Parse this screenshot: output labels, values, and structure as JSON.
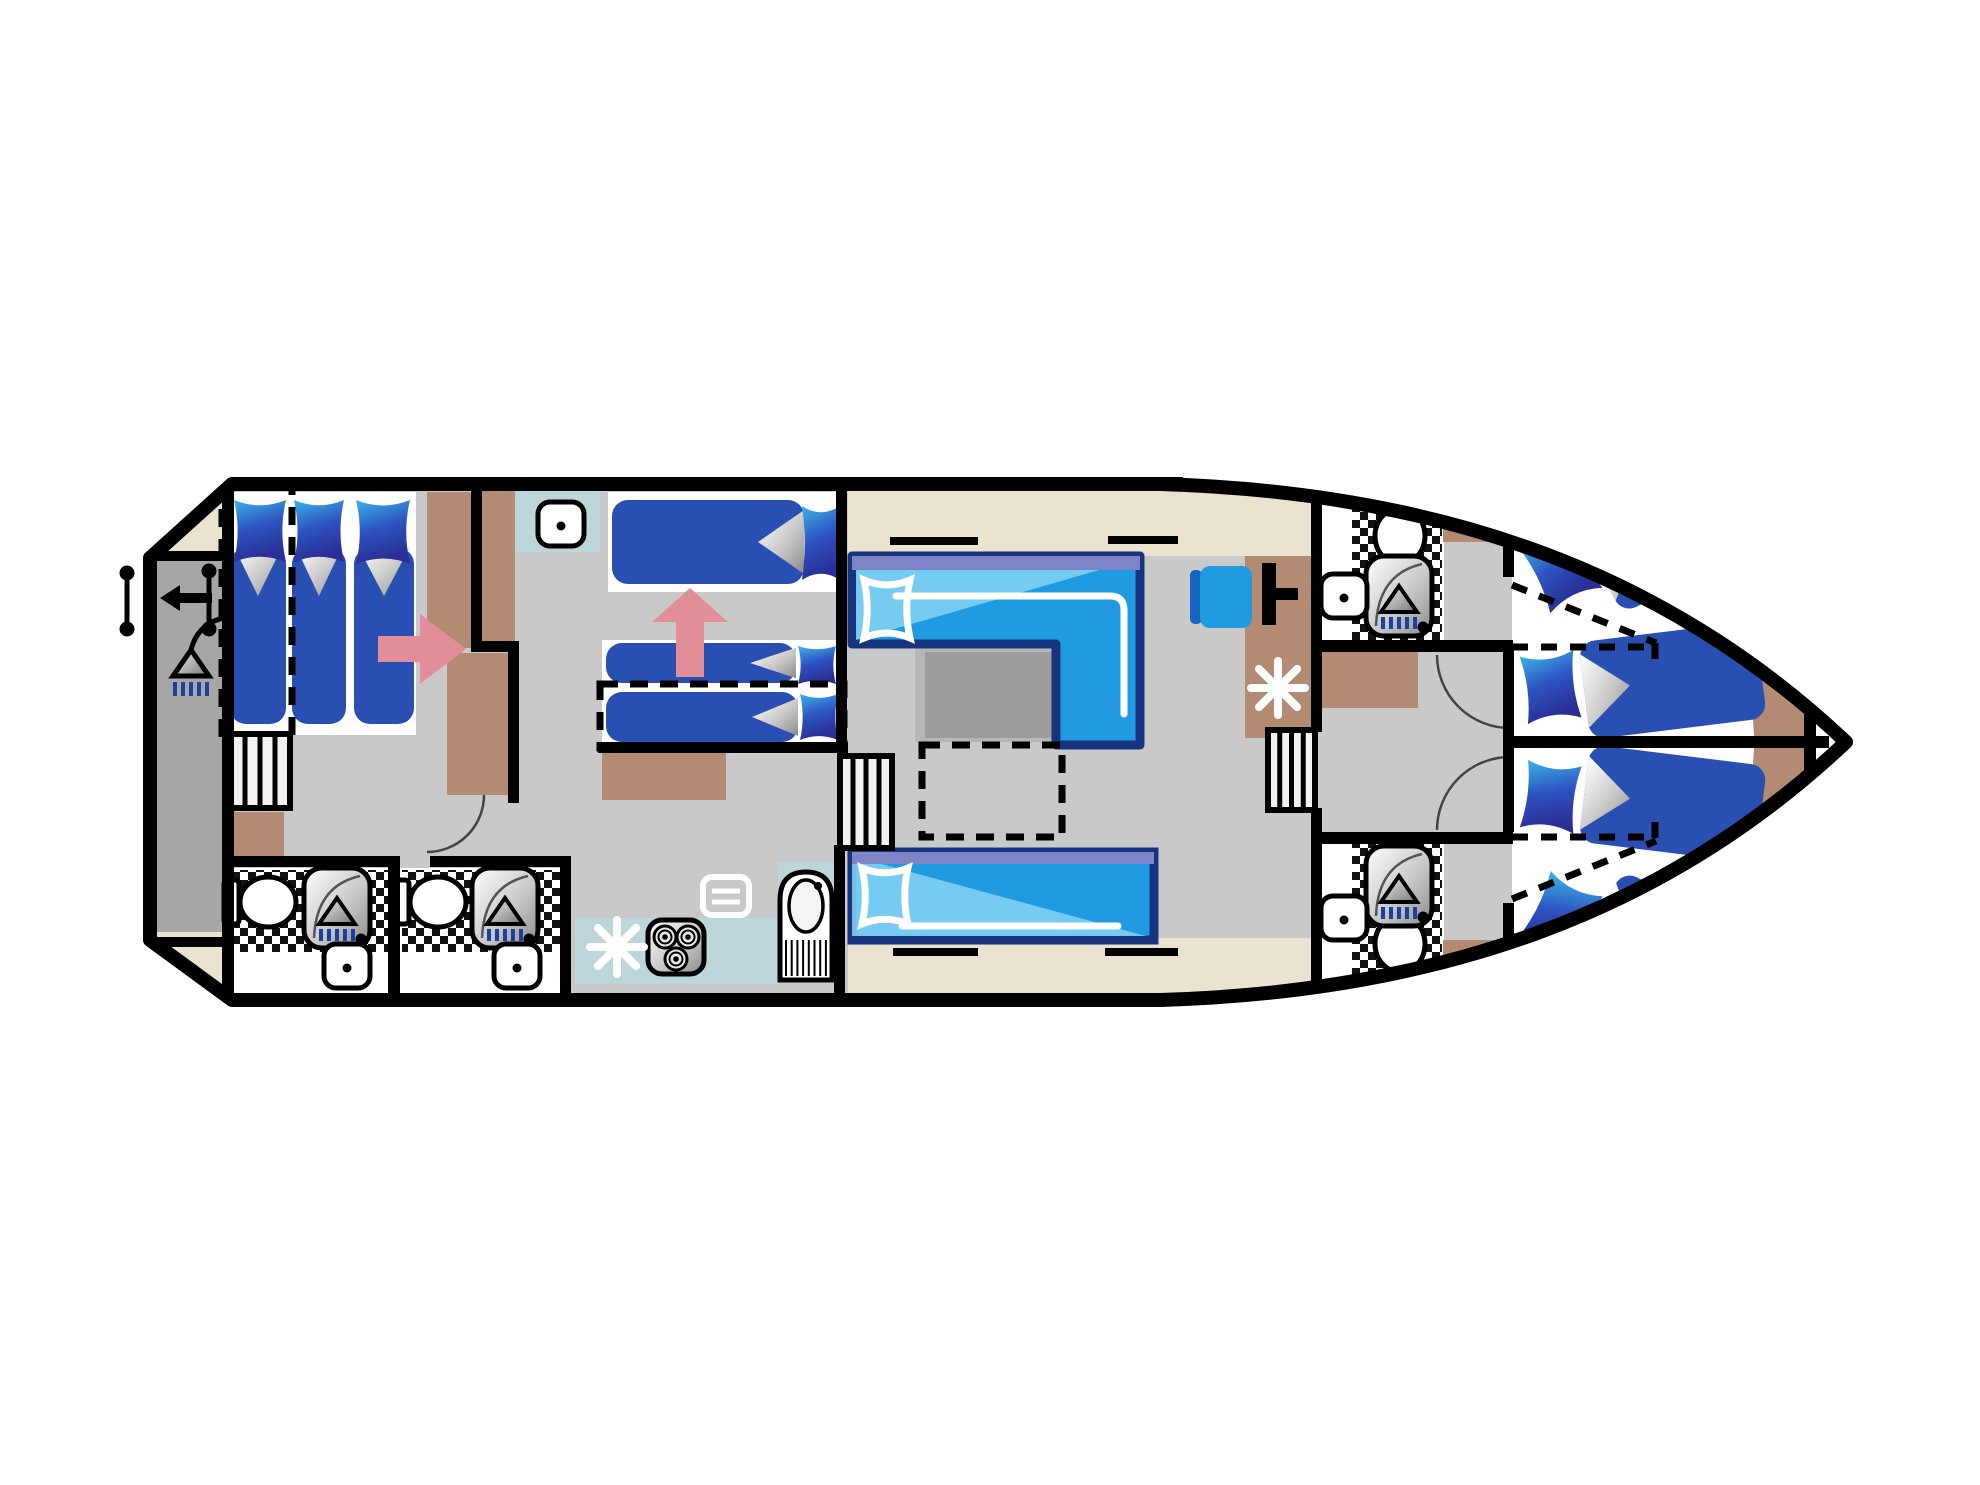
{
  "plan": {
    "meta": {
      "type": "boat-deck-floor-plan",
      "orientation": "bow-right-stern-left"
    },
    "palette": {
      "floor": "#c9c9c9",
      "platform": "#a6a6a6",
      "cream": "#e9e3d0",
      "brown": "#b28b72",
      "teal": "#bcd6d9",
      "duvet": "#2a4fb2",
      "pillowLight": "#3cb4e8",
      "pillowDark": "#2a2e96",
      "sofa": "#209be2",
      "sofaLight": "#7fd0f4",
      "sofaBorder": "#17357e",
      "sofaPurple": "#7d85c8",
      "tableLight": "#b6b6b6",
      "tableDark": "#9c9c9c",
      "pink": "#e28e98",
      "drip": "#1c3fa4",
      "wall": "#000000",
      "white": "#ffffff",
      "stairFill": "#f2f2f2"
    },
    "hull": {
      "path": "M 232,484 L 1160,484 C 1430,492 1660,566 1846,742 C 1660,918 1430,992 1160,1000 L 232,1000 L 150,940 L 150,558 Z",
      "strokeWidth": 14,
      "hatchBar": [
        1103,
        477,
        80,
        13
      ]
    },
    "floors": {
      "platform": [
        150,
        560,
        74,
        378
      ],
      "creams": [
        [
          150,
          487,
          82,
          68
        ],
        [
          150,
          932,
          82,
          66
        ],
        [
          848,
          488,
          467,
          68
        ],
        [
          848,
          938,
          467,
          62
        ]
      ],
      "creamTip": "M 1816,648 Q 1838,698 1843,742 Q 1838,786 1816,836 Z",
      "whiteRooms": [
        [
          232,
          868,
          160,
          130
        ],
        [
          400,
          868,
          162,
          130
        ],
        [
          1322,
          487,
          122,
          156
        ],
        [
          1322,
          842,
          122,
          156
        ],
        [
          1512,
          486,
          342,
          516
        ]
      ],
      "mattresses": [
        [
          226,
          492,
          126,
          243
        ],
        [
          348,
          492,
          68,
          243
        ],
        [
          608,
          492,
          236,
          100
        ],
        [
          602,
          640,
          242,
          106
        ]
      ],
      "teals": [
        [
          512,
          490,
          88,
          62
        ],
        [
          575,
          918,
          265,
          66
        ],
        [
          778,
          862,
          62,
          122
        ]
      ],
      "tiles": [
        [
          234,
          870,
          154,
          82
        ],
        [
          402,
          870,
          160,
          82
        ],
        [
          1352,
          492,
          90,
          150
        ],
        [
          1352,
          842,
          90,
          150
        ]
      ],
      "browns": [
        [
          427,
          492,
          46,
          156
        ],
        [
          477,
          490,
          38,
          158
        ],
        [
          447,
          653,
          62,
          142
        ],
        [
          228,
          812,
          56,
          48
        ],
        [
          602,
          750,
          124,
          50
        ],
        [
          1245,
          556,
          70,
          182
        ],
        [
          1320,
          652,
          98,
          56
        ],
        [
          1443,
          490,
          68,
          52
        ],
        [
          1443,
          940,
          68,
          53
        ]
      ],
      "brownPaths": [
        "M 1736,564 L 1776,594 L 1798,652 L 1806,736 L 1754,736 L 1748,640 Z",
        "M 1754,748 L 1806,748 L 1798,832 L 1776,890 L 1736,920 L 1748,844 Z"
      ]
    },
    "walls": [
      [
        222,
        484,
        12,
        518
      ],
      [
        150,
        551,
        82,
        10
      ],
      [
        150,
        937,
        82,
        10
      ],
      [
        471,
        487,
        11,
        160
      ],
      [
        471,
        641,
        48,
        11
      ],
      [
        508,
        648,
        11,
        155
      ],
      [
        232,
        856,
        158,
        11
      ],
      [
        430,
        856,
        140,
        11
      ],
      [
        388,
        856,
        12,
        144
      ],
      [
        560,
        856,
        11,
        144
      ],
      [
        836,
        487,
        11,
        260
      ],
      [
        598,
        742,
        250,
        11
      ],
      [
        834,
        845,
        11,
        155
      ],
      [
        1311,
        487,
        11,
        245
      ],
      [
        1311,
        808,
        11,
        192
      ],
      [
        1321,
        640,
        192,
        12
      ],
      [
        1321,
        832,
        192,
        12
      ],
      [
        1503,
        487,
        11,
        90
      ],
      [
        1503,
        648,
        11,
        184
      ],
      [
        1503,
        903,
        11,
        99
      ],
      [
        1513,
        736,
        316,
        12
      ],
      [
        1804,
        644,
        12,
        200
      ]
    ],
    "dashedRects": [
      {
        "name": "aft-convertible-bed-outline",
        "r": [
          222,
          487,
          70,
          250
        ]
      },
      {
        "name": "mid-pullout-bed-outline",
        "r": [
          600,
          684,
          244,
          64
        ]
      },
      {
        "name": "salon-table-extension",
        "r": [
          922,
          745,
          140,
          92
        ]
      }
    ],
    "dashedLines": [
      [
        1512,
        585,
        1656,
        643
      ],
      [
        1512,
        647,
        1652,
        647
      ],
      [
        1655,
        643,
        1655,
        662
      ],
      [
        1512,
        899,
        1656,
        841
      ],
      [
        1512,
        837,
        1652,
        837
      ],
      [
        1655,
        822,
        1655,
        841
      ]
    ],
    "beds": [
      {
        "name": "aft-cabin-bed-1",
        "pillow": [
          234,
          500,
          52,
          62
        ],
        "duvet": [
          230,
          548,
          56,
          176
        ],
        "fold": "top"
      },
      {
        "name": "aft-cabin-bed-2",
        "pillow": [
          294,
          500,
          50,
          62
        ],
        "duvet": [
          292,
          548,
          54,
          176
        ],
        "fold": "top"
      },
      {
        "name": "aft-cabin-bed-3",
        "pillow": [
          356,
          500,
          54,
          64
        ],
        "duvet": [
          354,
          548,
          60,
          176
        ],
        "fold": "top"
      },
      {
        "name": "mid-cabin-bed",
        "pillow": [
          802,
          506,
          38,
          74
        ],
        "duvet": [
          612,
          500,
          192,
          84
        ],
        "fold": "right"
      },
      {
        "name": "mid-cabin-pullout-upper",
        "pillow": [
          798,
          646,
          38,
          38
        ],
        "duvet": [
          606,
          643,
          190,
          40
        ],
        "fold": "right"
      },
      {
        "name": "mid-cabin-pullout-lower",
        "pillow": [
          800,
          694,
          38,
          46
        ],
        "duvet": [
          606,
          692,
          192,
          50
        ],
        "fold": "right"
      },
      {
        "name": "bow-cabin-port-bed-outer",
        "pillow": [
          1532,
          512,
          58,
          74
        ],
        "duvet": [
          1596,
          500,
          162,
          118
        ],
        "fold": "left",
        "rot": -26,
        "c": [
          1600,
          560
        ]
      },
      {
        "name": "bow-cabin-port-bed-inner",
        "pillow": [
          1524,
          652,
          54,
          68
        ],
        "duvet": [
          1584,
          645,
          178,
          98
        ],
        "fold": "left",
        "rot": -7,
        "c": [
          1560,
          690
        ]
      },
      {
        "name": "bow-cabin-stbd-bed-inner",
        "pillow": [
          1524,
          764,
          54,
          68
        ],
        "duvet": [
          1584,
          741,
          178,
          98
        ],
        "fold": "left",
        "rot": 7,
        "c": [
          1560,
          795
        ]
      },
      {
        "name": "bow-cabin-stbd-bed-outer",
        "pillow": [
          1532,
          898,
          58,
          74
        ],
        "duvet": [
          1596,
          866,
          162,
          118
        ],
        "fold": "left",
        "rot": 26,
        "c": [
          1600,
          925
        ]
      }
    ],
    "sofas": {
      "top": {
        "path": "M 852,556 L 1140,556 L 1140,745 L 1056,745 L 1056,644 L 852,644 Z",
        "purple": [
          852,
          556,
          288,
          14
        ],
        "sheen": "M 856,560 L 1134,560 L 856,640 Z",
        "pillowOutline": [
          864,
          580,
          46,
          58
        ],
        "seam": "M 896,596 L 1110,596 Q 1124,596 1124,610 L 1124,714"
      },
      "bottom": {
        "rect": [
          852,
          852,
          302,
          88
        ],
        "purple": [
          852,
          852,
          302,
          12
        ],
        "sheen": "M 852,856 L 852,936 L 1146,936 Z",
        "pillowOutline": [
          862,
          868,
          46,
          56
        ],
        "seam": "M 902,926 L 1118,926"
      }
    },
    "table": {
      "outer": [
        915,
        612,
        147,
        130
      ],
      "inner": [
        925,
        652,
        137,
        86
      ]
    },
    "stairs": [
      {
        "name": "aft-cabin-stairs",
        "r": [
          230,
          734,
          60,
          74
        ]
      },
      {
        "name": "salon-port-stairs",
        "r": [
          840,
          756,
          52,
          92
        ]
      },
      {
        "name": "salon-stbd-stairs",
        "r": [
          1268,
          730,
          47,
          80
        ]
      }
    ],
    "fixtures": {
      "toilets": [
        {
          "name": "aft-bathroom-1-toilet",
          "c": [
            264,
            902
          ],
          "rot": -90
        },
        {
          "name": "aft-bathroom-2-toilet",
          "c": [
            434,
            902
          ],
          "rot": -90
        },
        {
          "name": "fwd-bathroom-top-toilet",
          "c": [
            1400,
            532
          ],
          "rot": 0
        },
        {
          "name": "fwd-bathroom-bottom-toilet",
          "c": [
            1400,
            948
          ],
          "rot": 180
        }
      ],
      "showers": [
        {
          "name": "aft-bathroom-1-shower",
          "p": [
            304,
            868
          ]
        },
        {
          "name": "aft-bathroom-2-shower",
          "p": [
            472,
            868
          ]
        },
        {
          "name": "fwd-bathroom-top-shower",
          "p": [
            1366,
            556
          ]
        },
        {
          "name": "fwd-bathroom-bottom-shower",
          "p": [
            1366,
            846
          ]
        }
      ],
      "sinks": [
        {
          "name": "aft-bathroom-1-sink",
          "p": [
            324,
            944
          ]
        },
        {
          "name": "aft-bathroom-2-sink",
          "p": [
            494,
            944
          ]
        },
        {
          "name": "fwd-bathroom-top-sink",
          "p": [
            1321,
            574
          ]
        },
        {
          "name": "fwd-bathroom-bottom-sink",
          "p": [
            1321,
            896
          ]
        },
        {
          "name": "mid-cabin-vanity-sink",
          "p": [
            538,
            502
          ]
        }
      ],
      "cooktop": [
        648,
        920
      ],
      "fridge": [
        780,
        872
      ],
      "vent": [
        703,
        877
      ]
    },
    "icons": {
      "asterisks": [
        {
          "name": "galley-heater-icon",
          "c": [
            617,
            947
          ]
        },
        {
          "name": "salon-heater-icon",
          "c": [
            1278,
            688
          ]
        }
      ],
      "arrowRight": "M 378,636 L 420,636 L 420,614 L 466,649 L 420,684 L 420,662 L 378,662 Z",
      "arrowUp": "M 652,622 L 690,588 L 728,622 L 704,622 L 704,677 L 676,677 L 676,622 Z",
      "arrowLeft": "M 160,598 L 180,585 L 180,593 L 212,593 L 212,603 L 180,603 L 180,611 Z",
      "showerSymbol": {
        "hose": "M 228,617 Q 198,622 191,650",
        "tri": [
          [
            191,
            650
          ],
          [
            173,
            676
          ],
          [
            209,
            676
          ]
        ],
        "dripX": [
          175,
          183,
          191,
          199,
          207
        ],
        "dripY": [
          682,
          696
        ]
      },
      "ladders": [
        {
          "name": "swim-ladder-icon",
          "l": [
            127,
            573,
            127,
            629
          ]
        },
        {
          "name": "stern-rail-icon",
          "l": [
            209,
            571,
            209,
            629
          ]
        }
      ],
      "helm": [
        [
          1262,
          563,
          14,
          62
        ],
        [
          1276,
          588,
          22,
          12
        ]
      ],
      "chair": {
        "seat": [
          1200,
          566,
          52,
          62
        ],
        "back": [
          1190,
          570,
          12,
          54
        ]
      },
      "windowBars": [
        [
          890,
          537,
          88,
          8
        ],
        [
          1108,
          536,
          70,
          8
        ],
        [
          893,
          948,
          85,
          8
        ],
        [
          1105,
          948,
          73,
          8
        ]
      ],
      "doorArcs": [
        "M 427,852 A 57 57 0 0 0 484,795",
        "M 1437,655 A 73 73 0 0 0 1510,728",
        "M 1437,830 A 73 73 0 0 1 1510,757"
      ]
    }
  }
}
